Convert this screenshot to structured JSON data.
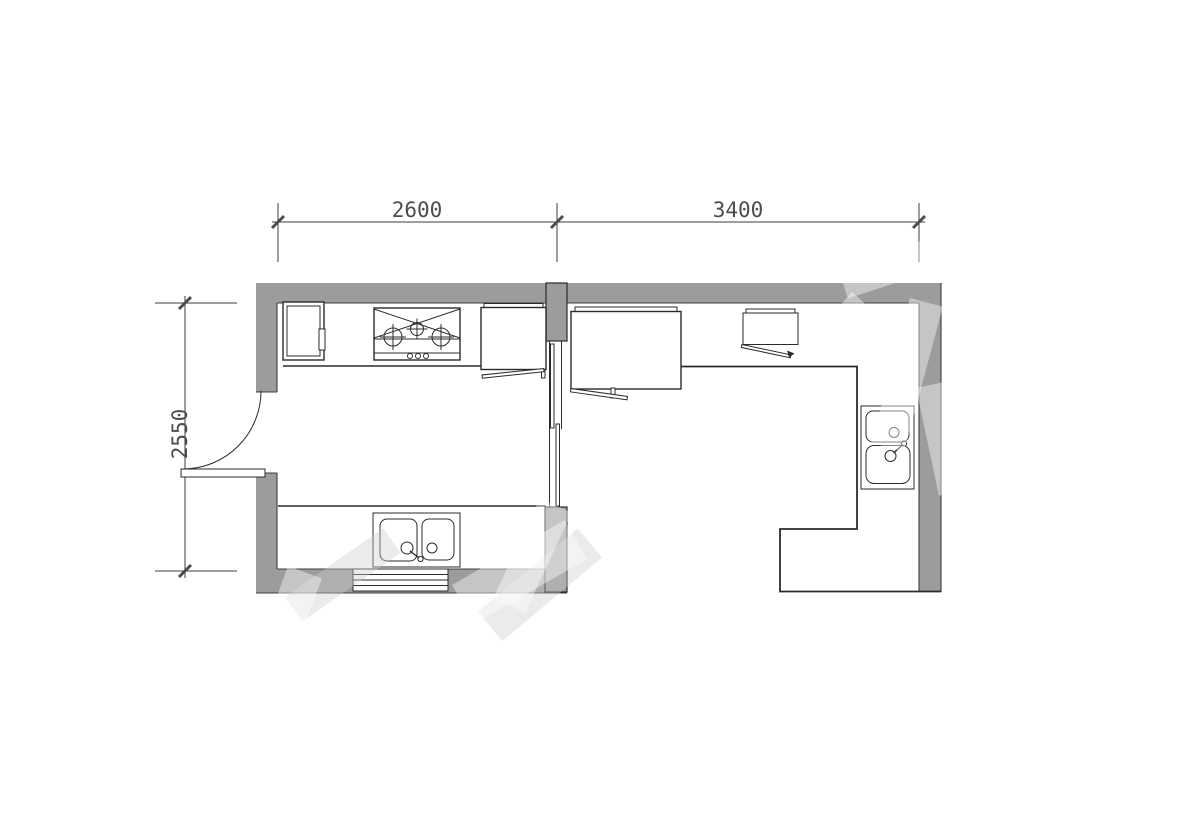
{
  "diagram": {
    "type": "floor-plan",
    "title": "kitchen-and-utility-room-plan",
    "units": "mm",
    "dimensions": {
      "top_left_width": "2600",
      "top_right_width": "3400",
      "left_height": "2550"
    },
    "fixtures": [
      "wall-cabinet",
      "gas-stove-3-burner",
      "tall-cabinet-with-open-door",
      "sliding-door",
      "double-bowl-sink-horizontal",
      "window-3-pane",
      "hinged-entry-door",
      "refrigerator-with-open-door",
      "small-wall-cabinet-with-open-door",
      "l-shaped-counter",
      "double-bowl-sink-vertical"
    ],
    "colors": {
      "background": "#ffffff",
      "wall_fill": "#9c9c9c",
      "edge": "#3d3d3d",
      "line": "#2b2b2b",
      "dim_line": "#3d3d3d",
      "dim_text": "#4d4d4d",
      "watermark_light": "rgba(255,255,255,0.42)",
      "watermark_gray": "rgba(205,205,205,0.40)"
    }
  }
}
